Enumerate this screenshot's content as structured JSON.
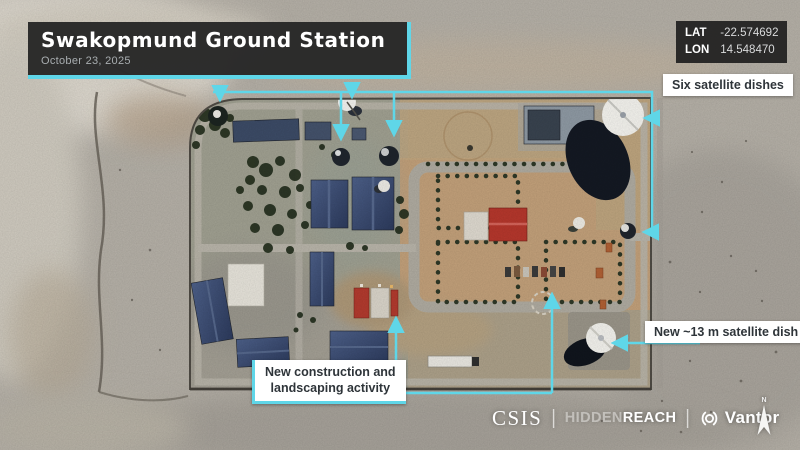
{
  "colors": {
    "accent_cyan": "#5FD6E8",
    "panel_dark": "#262626",
    "label_bg": "#FFFFFF",
    "label_text": "#2E3439"
  },
  "header": {
    "title": "Swakopmund Ground Station",
    "date": "October 23, 2025"
  },
  "coords": {
    "lat_label": "LAT",
    "lat_value": "-22.574692",
    "lon_label": "LON",
    "lon_value": "14.548470"
  },
  "annotations": {
    "six_dishes": "Six satellite dishes",
    "new_dish": "New ~13 m satellite dish",
    "construction_line1": "New construction and",
    "construction_line2": "landscaping activity"
  },
  "footer": {
    "csis": "CSIS",
    "separator": "|",
    "hidden": "HIDDEN",
    "reach": "REACH",
    "vantor": "Vantor",
    "north": "N"
  },
  "icons": {
    "vantor_logo": "aperture-ring-icon",
    "north_arrow": "compass-north-arrow-icon"
  }
}
